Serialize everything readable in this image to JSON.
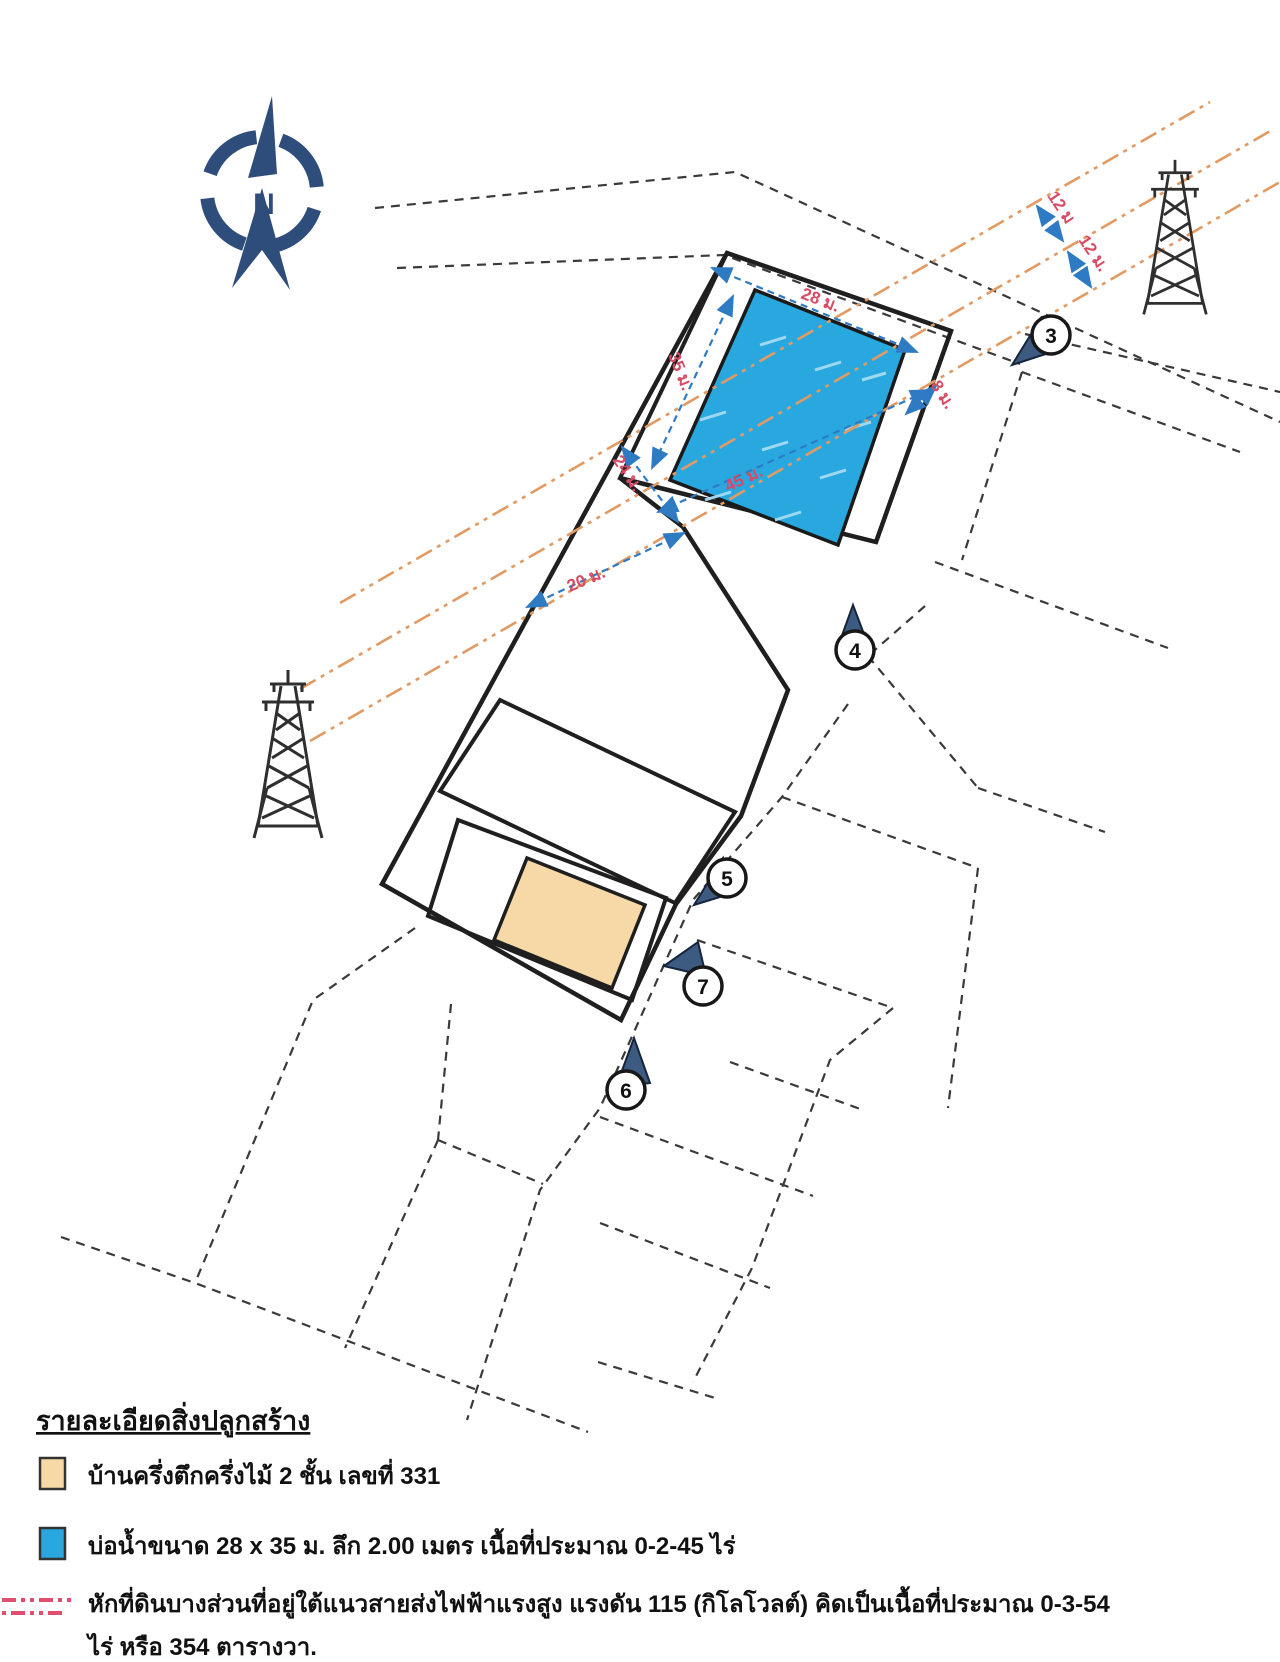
{
  "compass": {
    "label": "N",
    "color": "#2e4d7b"
  },
  "map": {
    "colors": {
      "pond": "#29a8e0",
      "pond_border": "#1a1a1a",
      "house": "#f7d9a8",
      "plot_line": "#1f1f1f",
      "parcel_dash": "#3a3a3a",
      "powerline_orange": "#e29a63",
      "dimension_red": "#d84a63",
      "arrow_blue": "#2e7bc4",
      "pin_navy": "#3d5a80"
    },
    "dimension_labels": [
      {
        "text": "28 ม."
      },
      {
        "text": "35 ม."
      },
      {
        "text": "45 ม."
      },
      {
        "text": "8 ม."
      },
      {
        "text": "24 ม."
      },
      {
        "text": "20 ม."
      },
      {
        "text": "12 ม"
      },
      {
        "text": "12 ม."
      }
    ],
    "markers": [
      {
        "number": "3"
      },
      {
        "number": "4"
      },
      {
        "number": "5"
      },
      {
        "number": "6"
      },
      {
        "number": "7"
      }
    ]
  },
  "legend": {
    "title": "รายละเอียดสิ่งปลูกสร้าง",
    "items": [
      {
        "color": "#f7d9a8",
        "text": "บ้านครึ่งตึกครึ่งไม้ 2 ชั้น เลขที่ 331"
      },
      {
        "color": "#29a8e0",
        "text": "บ่อน้ำขนาด 28 x 35 ม. ลึก 2.00  เมตร  เนื้อที่ประมาณ 0-2-45 ไร่"
      },
      {
        "color": "#e0506e",
        "text": "หักที่ดินบางส่วนที่อยู่ใต้แนวสายส่งไฟฟ้าแรงสูง แรงดัน 115 (กิโลโวลต์) คิดเป็นเนื้อที่ประมาณ 0-3-54",
        "text2": "ไร่ หรือ 354 ตารางวา."
      }
    ]
  }
}
